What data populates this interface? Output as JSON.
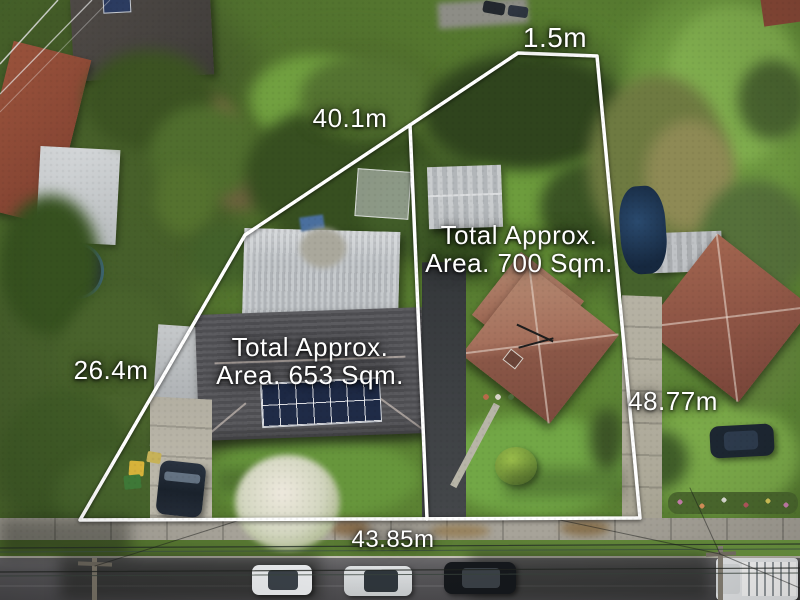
{
  "scene": {
    "description": "Aerial drone photograph of two adjoining residential lots outlined with white boundary lines and measurement annotations",
    "annotation_color": "#ffffff"
  },
  "measurements": {
    "top": "1.5m",
    "rear": "40.1m",
    "left": "26.4m",
    "right": "48.77m",
    "front": "43.85m"
  },
  "lots": [
    {
      "name": "left-lot",
      "area_line1": "Total Approx.",
      "area_line2": "Area. 653 Sqm."
    },
    {
      "name": "right-lot",
      "area_line1": "Total Approx.",
      "area_line2": "Area. 700 Sqm."
    }
  ]
}
